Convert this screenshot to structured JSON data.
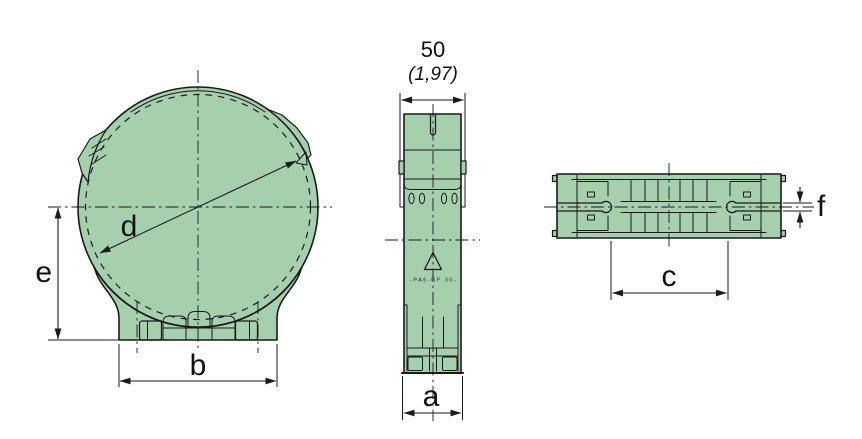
{
  "drawing": {
    "background_color": "#ffffff",
    "part_fill_color": "#a6cfae",
    "line_color": "#1a1a1a"
  },
  "front_view": {
    "dim_b": "b",
    "dim_d": "d",
    "dim_e": "e"
  },
  "side_view": {
    "width_mm": "50",
    "width_inches": "(1,97)",
    "material_marking": "-PA6-GF 30-",
    "dim_a": "a"
  },
  "bottom_view": {
    "dim_c": "c",
    "dim_f": "f"
  }
}
